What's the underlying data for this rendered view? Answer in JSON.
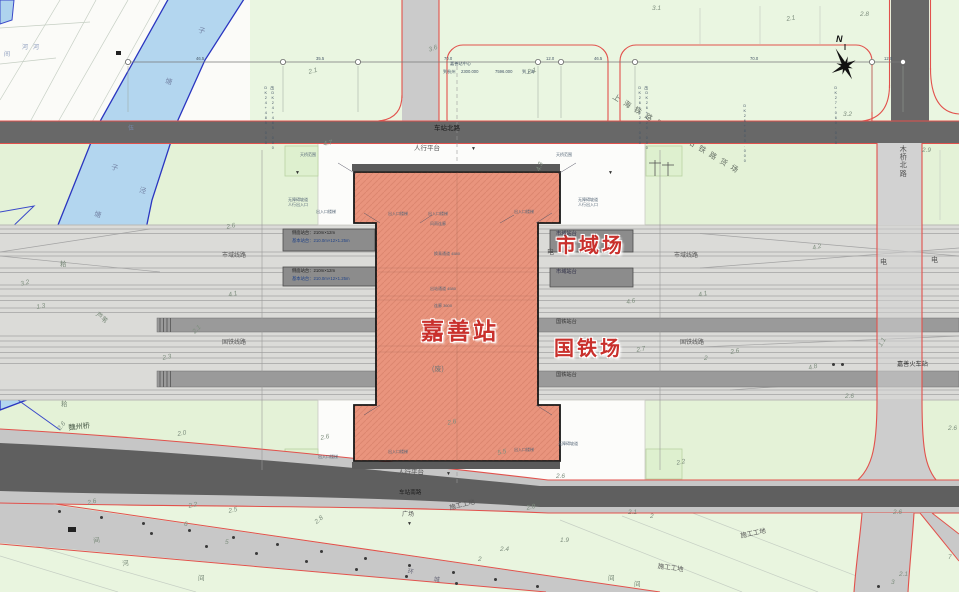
{
  "station": {
    "name": "嘉善站",
    "yard_labels": [
      "市域场",
      "国铁场"
    ],
    "freight_label": "上海铁路局嘉善站铁路货场",
    "old_station_label": "嘉善火车站"
  },
  "compass": {
    "north_label": "N"
  },
  "colors": {
    "building_fill": "#e9947d",
    "road_edge_red": "#e2514c",
    "dark_road": "#686868",
    "rail_corridor": "#dbdbd8",
    "platform_gray": "#9a9a9a",
    "river_blue": "#b3d6ef",
    "parcel_green": "#e4f2d7",
    "annotation_red": "#c9302c"
  },
  "red_labels": [
    [
      556,
      236,
      "市域场",
      0,
      20
    ],
    [
      421,
      320,
      "嘉善站",
      0,
      23
    ],
    [
      554,
      339,
      "国铁场",
      0,
      20
    ]
  ],
  "road_labels": [
    [
      434,
      126,
      "车站北路",
      0,
      6.5,
      "#1b1b1b"
    ],
    [
      399,
      491,
      "车站南路",
      0,
      5.6,
      "#1b1b1b"
    ],
    [
      68,
      424,
      "魏州桥",
      -6,
      7.2,
      "#445544"
    ],
    [
      900,
      145,
      "木桥北路",
      0,
      7.2,
      "#555555",
      1
    ]
  ],
  "area_labels": [
    [
      414,
      146,
      "人行平台"
    ],
    [
      398,
      470,
      "人行平台"
    ],
    [
      222,
      253,
      "市域线路",
      0,
      6
    ],
    [
      674,
      253,
      "市域线路",
      0,
      6
    ],
    [
      222,
      340,
      "国铁线路",
      0,
      6
    ],
    [
      680,
      340,
      "国铁线路",
      0,
      6
    ],
    [
      556,
      320,
      "国铁站台",
      0,
      5.2,
      "#333333"
    ],
    [
      556,
      373,
      "国铁站台",
      0,
      5.2,
      "#333333"
    ],
    [
      556,
      270,
      "市域站台",
      0,
      5.2,
      "#2c2c45"
    ],
    [
      556,
      232,
      "市域站台",
      0,
      5.2,
      "#2c2c45"
    ],
    [
      449,
      506,
      "施工工地",
      -14
    ],
    [
      740,
      534,
      "施工工地",
      -12
    ],
    [
      658,
      564,
      "施工工地",
      8
    ],
    [
      402,
      512,
      "广场",
      0,
      6
    ],
    [
      547,
      249,
      "电",
      0,
      7
    ],
    [
      880,
      259,
      "电",
      0,
      7
    ],
    [
      931,
      257,
      "电",
      0,
      7
    ],
    [
      432,
      366,
      "(废)",
      0,
      7,
      "#777777"
    ],
    [
      897,
      362,
      "嘉善火车站",
      0,
      6.2,
      "#333333"
    ],
    [
      60,
      262,
      "耠",
      0,
      6.5,
      "#778877"
    ],
    [
      98,
      312,
      "芦苇",
      40,
      6.5,
      "#778877"
    ],
    [
      61,
      402,
      "耠",
      0,
      6.5,
      "#778877"
    ],
    [
      93,
      539,
      "间",
      -10,
      6.5,
      "#778877"
    ],
    [
      122,
      562,
      "河",
      -10,
      6.5,
      "#778877"
    ],
    [
      198,
      576,
      "间",
      0,
      6.5,
      "#778877"
    ],
    [
      608,
      576,
      "间",
      0,
      6.5,
      "#778877"
    ],
    [
      634,
      582,
      "间",
      0,
      6.5,
      "#778877"
    ],
    [
      408,
      569,
      "环",
      8,
      6,
      "#666677"
    ],
    [
      434,
      577,
      "城",
      8,
      6,
      "#666677"
    ],
    [
      471,
      147,
      "▼",
      0,
      5,
      "#333333"
    ],
    [
      295,
      171,
      "▼",
      0,
      5,
      "#333333"
    ],
    [
      608,
      171,
      "▼",
      0,
      5,
      "#333333"
    ],
    [
      407,
      522,
      "▼",
      0,
      5,
      "#333333"
    ],
    [
      446,
      472,
      "▼",
      0,
      5,
      "#333333"
    ]
  ],
  "water_labels": [
    [
      199,
      27,
      "子",
      15
    ],
    [
      166,
      78,
      "塘",
      15
    ],
    [
      128,
      126,
      "伍",
      0,
      6
    ],
    [
      112,
      164,
      "子",
      15
    ],
    [
      140,
      187,
      "泾",
      15
    ],
    [
      95,
      211,
      "塘",
      15
    ],
    [
      22,
      45,
      "河",
      0,
      6,
      "#8899bb"
    ],
    [
      33,
      45,
      "河",
      0,
      6,
      "#8899bb"
    ],
    [
      4,
      52,
      "间",
      0,
      6,
      "#8899bb"
    ]
  ],
  "platform_labels": [
    [
      292,
      231,
      "侧面站台：210m×12m"
    ],
    [
      292,
      239,
      "基本站台：210.0m×12×1.25m",
      0,
      4.3,
      "#224488"
    ],
    [
      292,
      269,
      "侧面站台：210m×12m"
    ],
    [
      292,
      277,
      "基本站台：210.0m×12×1.25m",
      0,
      4.3,
      "#224488"
    ]
  ],
  "micro_annotations": [
    [
      288,
      198,
      "无障碍坡道"
    ],
    [
      288,
      203,
      "人行出入口"
    ],
    [
      578,
      198,
      "无障碍坡道"
    ],
    [
      578,
      203,
      "人行出入口"
    ],
    [
      316,
      210,
      "出入口楼梯"
    ],
    [
      388,
      212,
      "出入口楼梯"
    ],
    [
      428,
      212,
      "出入口楼梯"
    ],
    [
      514,
      210,
      "出入口楼梯"
    ],
    [
      318,
      455,
      "出入口楼梯"
    ],
    [
      388,
      450,
      "出入口楼梯"
    ],
    [
      514,
      448,
      "出入口楼梯"
    ],
    [
      558,
      442,
      "无障碍坡道"
    ],
    [
      300,
      153,
      "天桥范围"
    ],
    [
      556,
      153,
      "天桥范围"
    ],
    [
      430,
      222,
      "风雨连廊"
    ],
    [
      434,
      252,
      "换乘通道 4580"
    ],
    [
      430,
      287,
      "出站通道 4580"
    ],
    [
      434,
      304,
      "连廊 3600"
    ]
  ],
  "dimension_labels": [
    [
      196,
      57,
      "46.5"
    ],
    [
      316,
      57,
      "35.5"
    ],
    [
      444,
      57,
      "70.0"
    ],
    [
      546,
      57,
      "12.0"
    ],
    [
      594,
      57,
      "46.5"
    ],
    [
      750,
      57,
      "70.0"
    ],
    [
      884,
      57,
      "12.0"
    ]
  ],
  "kilometer_labels": [
    [
      443,
      70,
      "到杭州"
    ],
    [
      461,
      70,
      "2300.000"
    ],
    [
      495,
      70,
      "7596.000"
    ],
    [
      522,
      70,
      "到上海"
    ],
    [
      450,
      62,
      "嘉善站中心"
    ]
  ],
  "chainage_marks": [
    [
      263,
      86,
      "DK24+485.000"
    ],
    [
      270,
      86,
      "改DK24+485.000"
    ],
    [
      637,
      86,
      "DK26+120.000"
    ],
    [
      644,
      86,
      "改DK26+120.000"
    ],
    [
      742,
      104,
      "DK26+800.000"
    ],
    [
      833,
      86,
      "DK27+060.000"
    ]
  ],
  "elevations": [
    [
      308,
      70,
      "2.1",
      -15
    ],
    [
      527,
      70,
      "2.1",
      -15
    ],
    [
      428,
      48,
      "3.6",
      -20
    ],
    [
      652,
      6,
      "3.1",
      0
    ],
    [
      860,
      12,
      "2.8",
      0
    ],
    [
      786,
      17,
      "2.1",
      -10
    ],
    [
      843,
      112,
      "3.2",
      0
    ],
    [
      922,
      148,
      "2.9",
      0
    ],
    [
      323,
      142,
      "4.7",
      -12
    ],
    [
      536,
      170,
      "4.3",
      -70
    ],
    [
      226,
      225,
      "2.6",
      -12
    ],
    [
      20,
      282,
      "3.2",
      -15
    ],
    [
      228,
      293,
      "4.1",
      -12
    ],
    [
      698,
      293,
      "4.1",
      -12
    ],
    [
      812,
      246,
      "4.2",
      -15
    ],
    [
      626,
      300,
      "4.6",
      -10
    ],
    [
      36,
      305,
      "1.3",
      -10
    ],
    [
      636,
      348,
      "2.7",
      -10
    ],
    [
      704,
      356,
      "2",
      0
    ],
    [
      730,
      350,
      "2.6",
      -10
    ],
    [
      878,
      345,
      "1.1",
      -60
    ],
    [
      808,
      366,
      "4.8",
      -15
    ],
    [
      162,
      356,
      "2.3",
      -12
    ],
    [
      192,
      331,
      "2.1",
      -45
    ],
    [
      177,
      432,
      "2.0",
      -10
    ],
    [
      845,
      394,
      "2.6",
      0
    ],
    [
      57,
      428,
      "2.6",
      -50
    ],
    [
      320,
      436,
      "2.6",
      -12
    ],
    [
      447,
      421,
      "2.6",
      -12
    ],
    [
      497,
      451,
      "5.5",
      -12
    ],
    [
      556,
      474,
      "2.6",
      0
    ],
    [
      676,
      461,
      "2.2",
      -12
    ],
    [
      948,
      426,
      "2.6",
      0
    ],
    [
      87,
      501,
      "2.6",
      -15
    ],
    [
      188,
      504,
      "2.2",
      -12
    ],
    [
      228,
      509,
      "2.5",
      -12
    ],
    [
      314,
      521,
      "2.8",
      -40
    ],
    [
      526,
      506,
      "2.0",
      -12
    ],
    [
      184,
      522,
      "6",
      0
    ],
    [
      225,
      540,
      "5",
      0
    ],
    [
      560,
      538,
      "1.9",
      0
    ],
    [
      893,
      510,
      "2.6",
      0
    ],
    [
      899,
      572,
      "2.1",
      0
    ],
    [
      891,
      580,
      "3",
      0
    ],
    [
      948,
      555,
      "7",
      0
    ],
    [
      628,
      510,
      "2.1",
      0
    ],
    [
      650,
      514,
      "2",
      0
    ],
    [
      500,
      547,
      "2.4",
      0
    ],
    [
      478,
      557,
      "2",
      0
    ]
  ],
  "tree_dots": [
    [
      58,
      510
    ],
    [
      100,
      516
    ],
    [
      142,
      522
    ],
    [
      188,
      529
    ],
    [
      232,
      536
    ],
    [
      276,
      543
    ],
    [
      320,
      550
    ],
    [
      364,
      557
    ],
    [
      408,
      564
    ],
    [
      452,
      571
    ],
    [
      494,
      578
    ],
    [
      536,
      585
    ],
    [
      150,
      532
    ],
    [
      205,
      545
    ],
    [
      255,
      552
    ],
    [
      305,
      560
    ],
    [
      355,
      568
    ],
    [
      405,
      575
    ],
    [
      455,
      582
    ],
    [
      832,
      363
    ],
    [
      841,
      363
    ],
    [
      877,
      585
    ]
  ]
}
